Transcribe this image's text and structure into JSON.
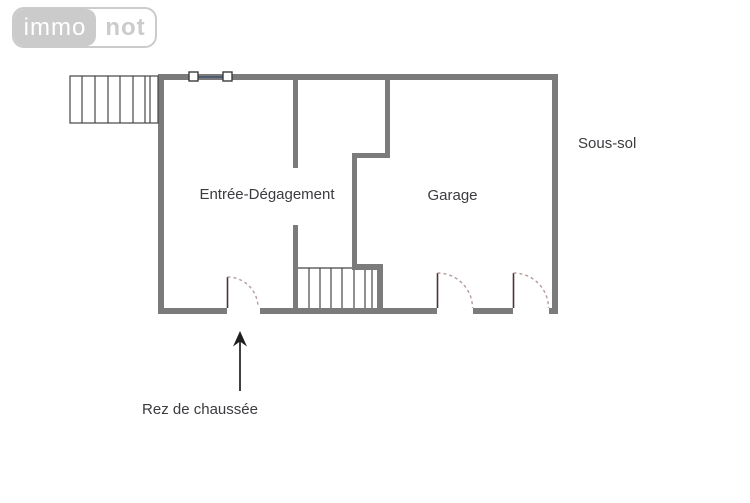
{
  "logo": {
    "brand_left": "immo",
    "brand_right": "not"
  },
  "plan": {
    "type": "floor-plan",
    "floor_title": "Sous-sol",
    "caption": "Rez de chaussée",
    "rooms": [
      {
        "label": "Entrée-Dégagement"
      },
      {
        "label": "Garage"
      }
    ],
    "symbols": [
      "exterior-stairs",
      "interior-stairs",
      "window-symbol",
      "door-swing-arc",
      "door-swing-arc",
      "door-swing-arc",
      "up-arrow"
    ]
  },
  "colors": {
    "wall-color": "#7b7b7b",
    "stair-color": "#454545",
    "door-leaf-color": "#4a3434",
    "door-arc-color": "#b49c9c",
    "window-color": "#3d4f70",
    "arrow-color": "#1f1f1f",
    "text-color": "#3b3b40",
    "logo-gray": "#cbcbcb"
  }
}
